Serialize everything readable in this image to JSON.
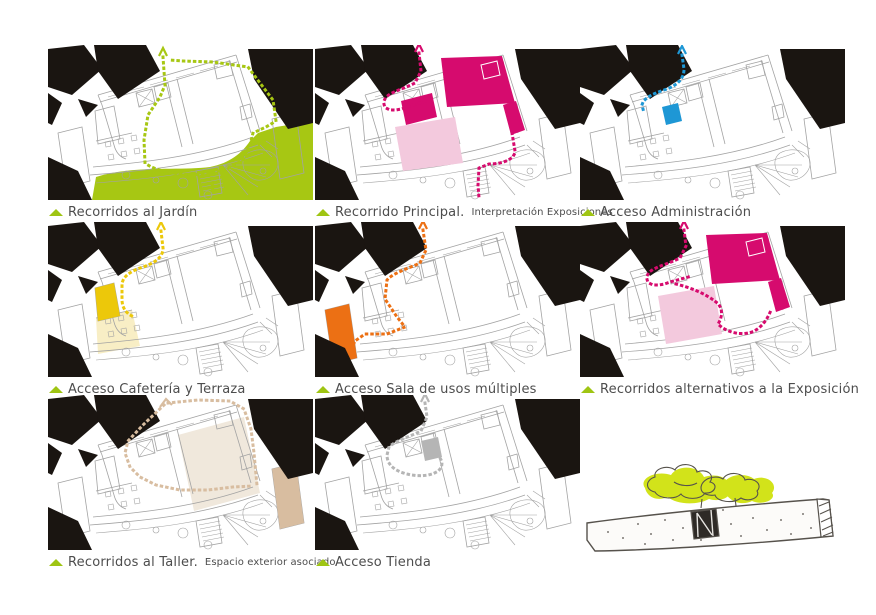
{
  "palette": {
    "ink": "#1a1511",
    "plan_line": "#a3a3a3",
    "legend_triangle": "#9fc513",
    "background": "#ffffff"
  },
  "panels": [
    {
      "id": "jardin",
      "label": "Recorridos al Jardín",
      "sublabel": "",
      "accent": "#a7c713",
      "fill": "#a7c713",
      "fill_light": "#a7c713"
    },
    {
      "id": "principal",
      "label": "Recorrido Principal.",
      "sublabel": "Interpretación Exposiciones",
      "accent": "#d60b6e",
      "fill": "#d60b6e",
      "fill_light": "#f3c9dd"
    },
    {
      "id": "administracion",
      "label": "Acceso Administración",
      "sublabel": "",
      "accent": "#1e97d5",
      "fill": "#1e97d5",
      "fill_light": "#1e97d5"
    },
    {
      "id": "cafeteria",
      "label": "Acceso Cafetería y Terraza",
      "sublabel": "",
      "accent": "#ecc80a",
      "fill": "#ecc80a",
      "fill_light": "#f8eec5"
    },
    {
      "id": "sala",
      "label": "Acceso Sala de usos múltiples",
      "sublabel": "",
      "accent": "#ec7014",
      "fill": "#ec7014",
      "fill_light": "#ec7014"
    },
    {
      "id": "alternativos",
      "label": "Recorridos alternativos a la Exposición",
      "sublabel": "",
      "accent": "#d60b6e",
      "fill": "#d60b6e",
      "fill_light": "#f3c9dd"
    },
    {
      "id": "taller",
      "label": "Recorridos al Taller.",
      "sublabel": "Espacio exterior asociado",
      "accent": "#d8bda0",
      "fill": "#d8bda0",
      "fill_light": "#f0e8dc"
    },
    {
      "id": "tienda",
      "label": "Acceso Tienda",
      "sublabel": "",
      "accent": "#b5b5b5",
      "fill": "#b5b5b5",
      "fill_light": "#b5b5b5"
    }
  ],
  "sketch": {
    "tree_color": "#d2e31a",
    "ink_color": "#56524c"
  }
}
